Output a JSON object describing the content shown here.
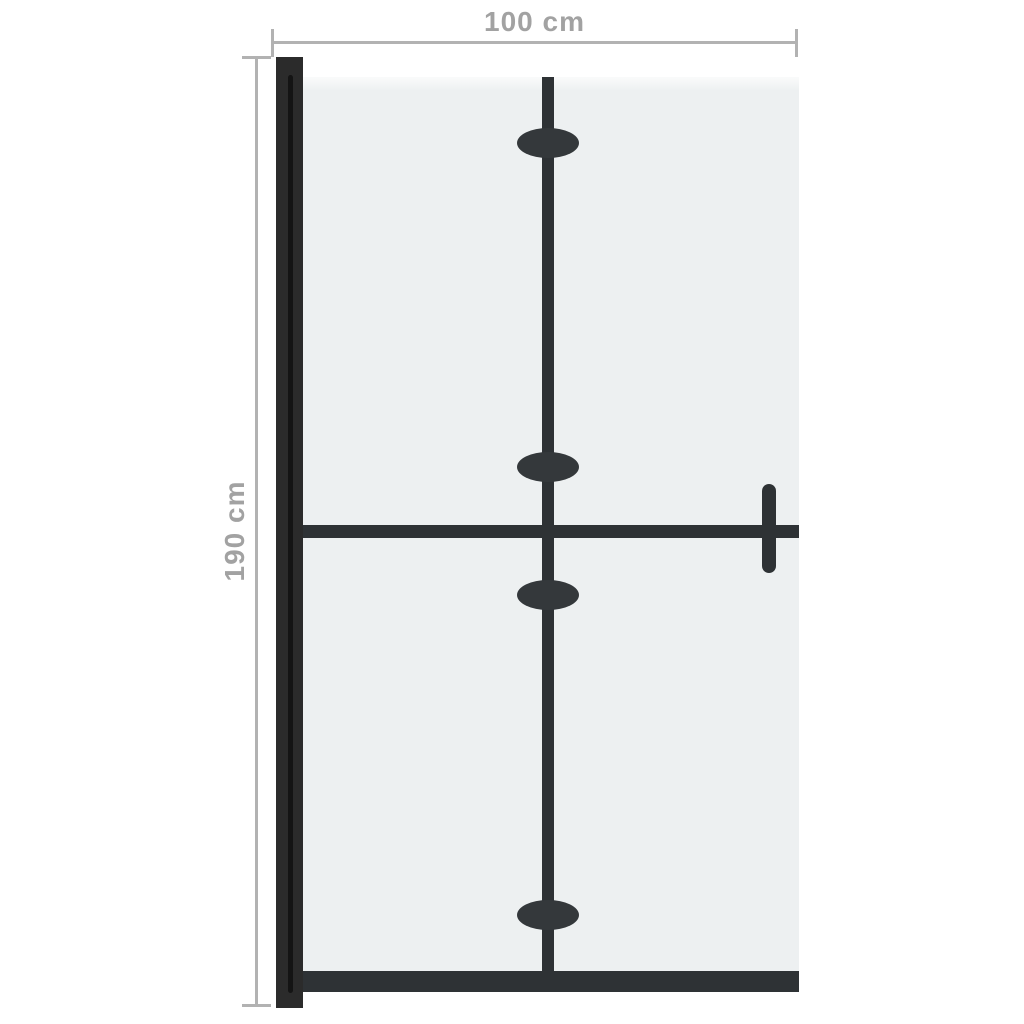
{
  "diagram": {
    "dimensions": {
      "width": "100 cm",
      "height": "190 cm"
    },
    "colors": {
      "background": "#ffffff",
      "glass": "#edf0f1",
      "glass_top_sheen": "#fafbfb",
      "frame": "#2b2b2b",
      "frame_groove": "#141414",
      "fold_line": "#2e3235",
      "hinge": "#34383b",
      "dimension_line": "#b2b2b2",
      "dimension_text": "#a2a2a2"
    }
  }
}
